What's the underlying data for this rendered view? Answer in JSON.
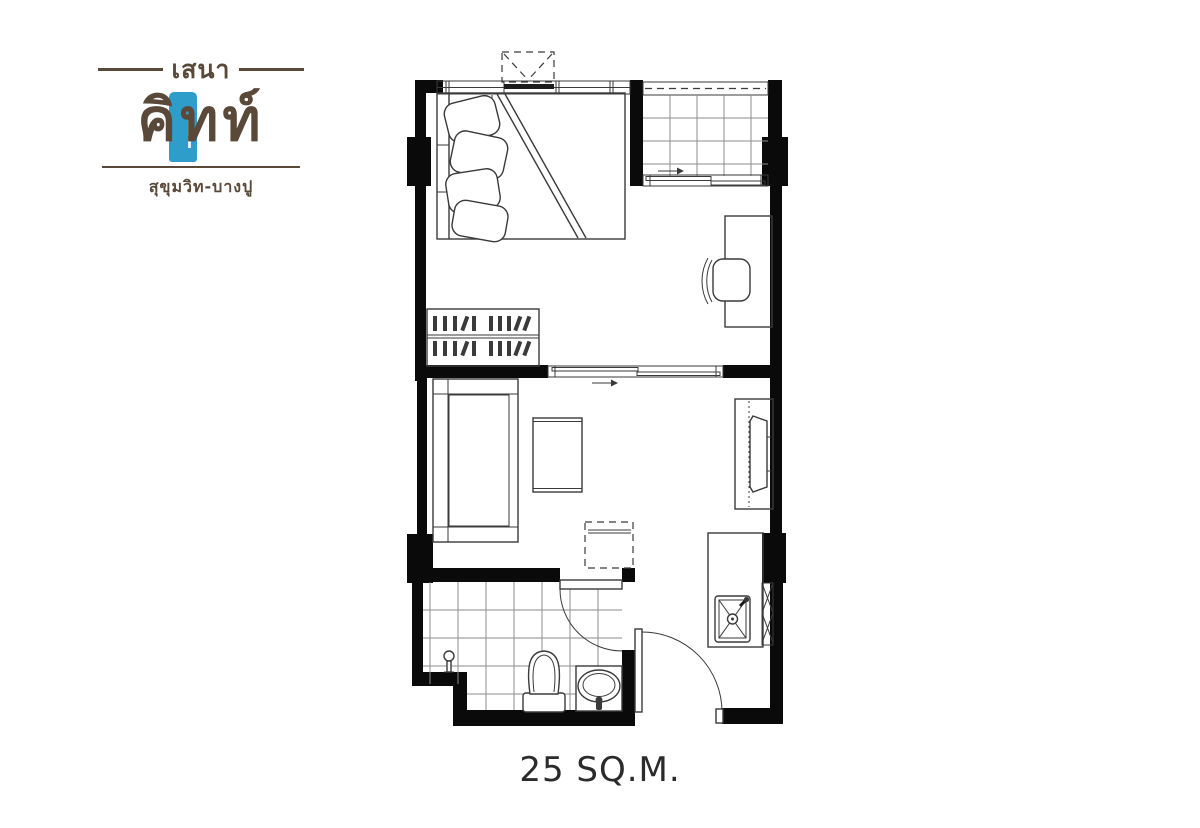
{
  "logo": {
    "line1": "เสนา",
    "name": "คิทท์",
    "subtitle": "สุขุมวิท-บางปู"
  },
  "floor_plan": {
    "area_label": "25 SQ.M.",
    "unit_type": "studio",
    "rooms": [
      "bedroom",
      "balcony",
      "workspace",
      "living-area",
      "kitchenette",
      "bathroom",
      "entry"
    ],
    "symbols": [
      "double-bed",
      "pillows",
      "blanket-fold",
      "wardrobe-with-hangers",
      "desk",
      "desk-chair",
      "sofa",
      "coffee-table",
      "dashed-optional-table",
      "tv-console",
      "tv",
      "air-conditioner-unit",
      "balcony-sliding-window",
      "partition-sliding-door",
      "bathroom-door-swing",
      "entrance-door-swing",
      "kitchen-counter",
      "kitchen-sink",
      "shower-fixture",
      "toilet",
      "washbasin"
    ]
  },
  "colors": {
    "brand-brown": "#5a4839",
    "brand-blue": "#2f9dc9",
    "ink": "#3a3a3a",
    "wall": "#0a0a0a",
    "grid": "#8c8c8c",
    "label": "#2b2b2b",
    "bg": "#ffffff"
  }
}
